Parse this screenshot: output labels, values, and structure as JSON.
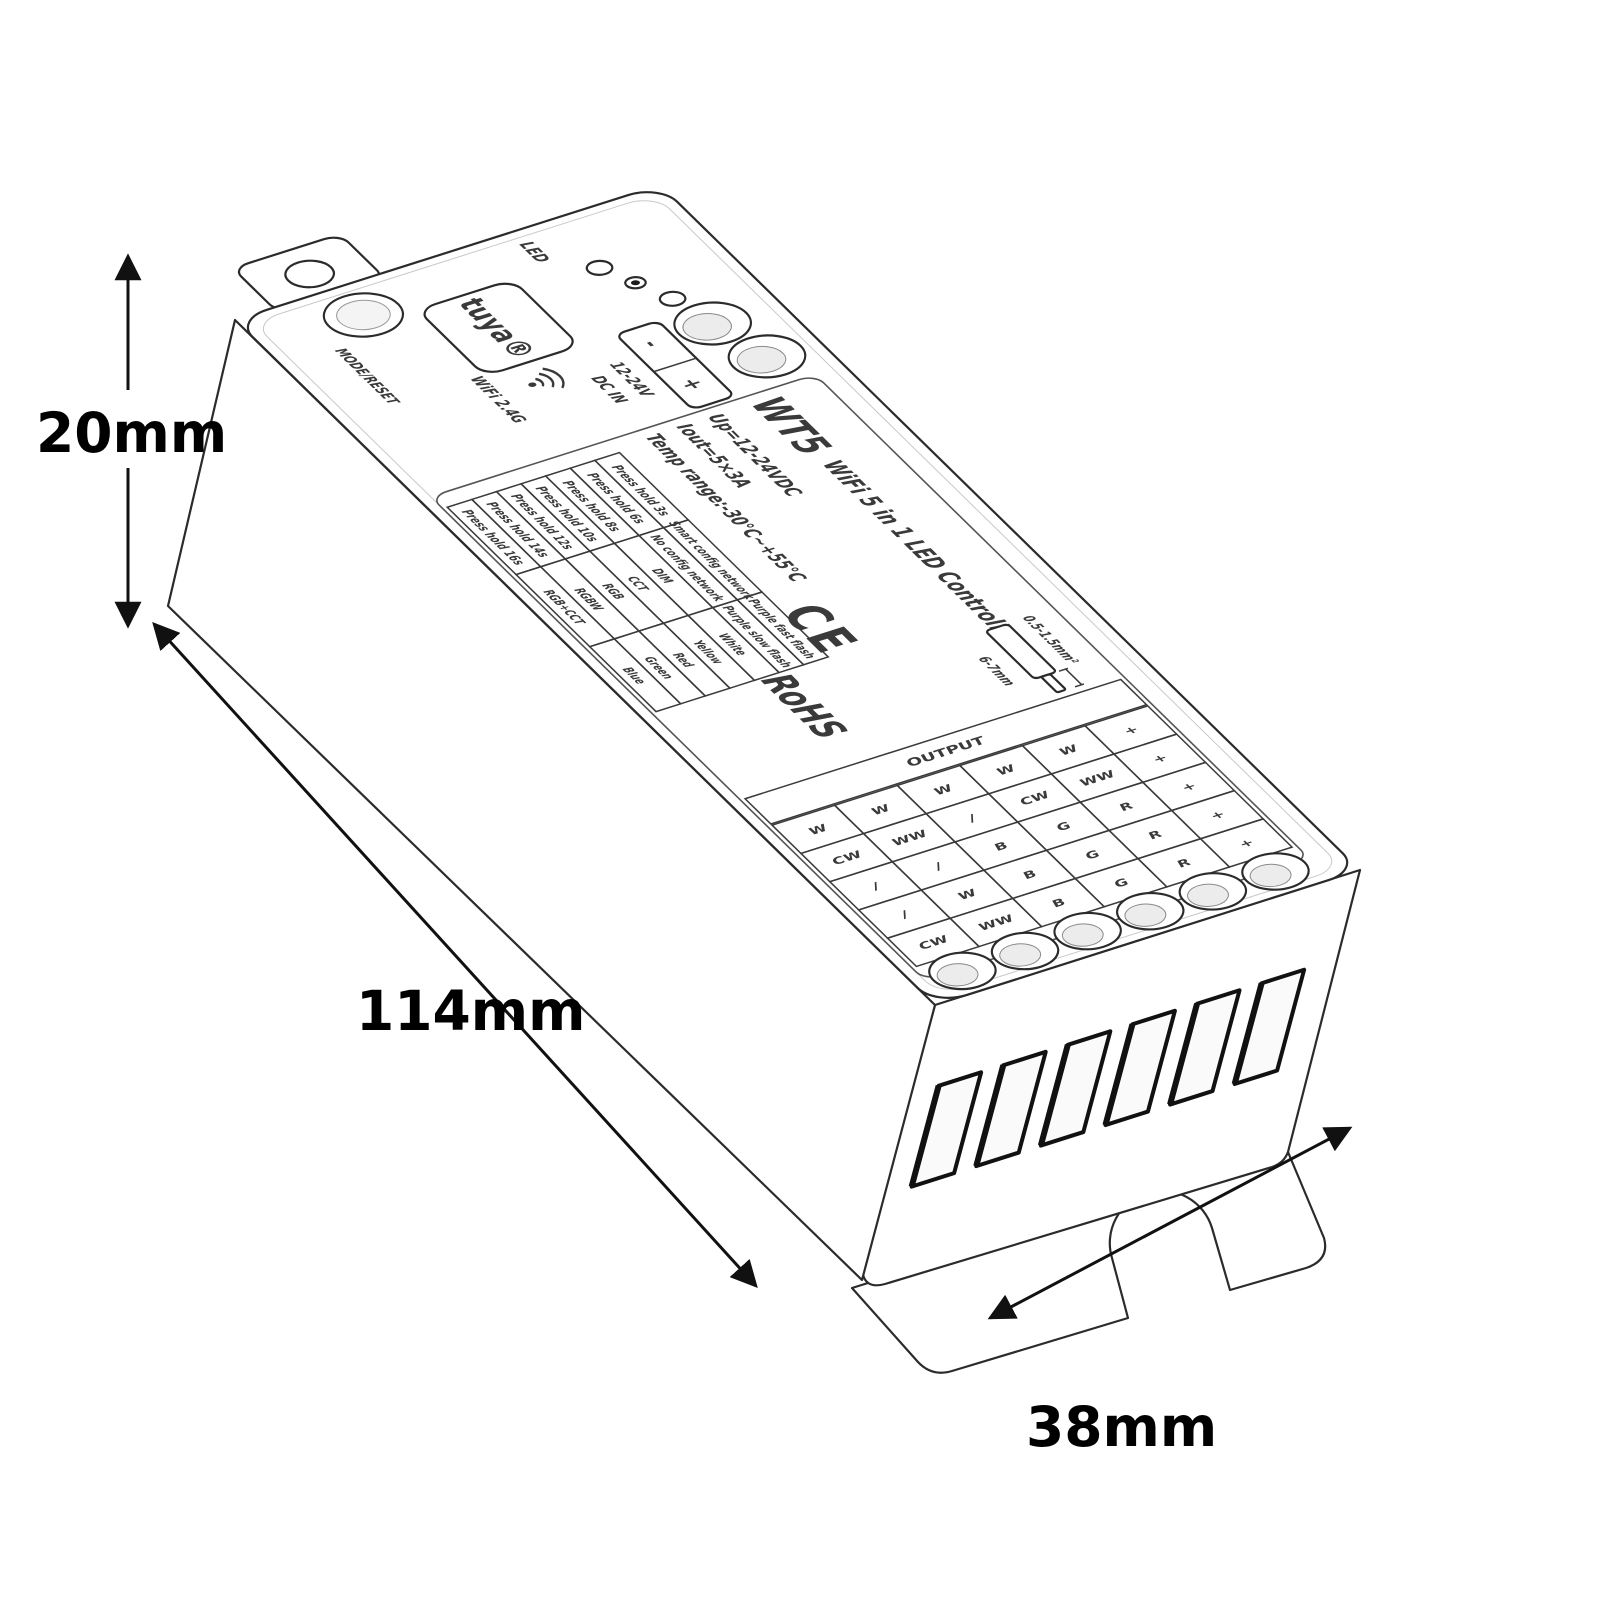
{
  "dimensions": {
    "height": "20mm",
    "length": "114mm",
    "width": "38mm"
  },
  "device": {
    "top": {
      "led_label": "LED",
      "button_label": "MODE/RESET",
      "brand": "tuya®",
      "wifi": "WiFi 2.4G",
      "power_in": {
        "neg": "-",
        "pos": "+",
        "line1": "12-24V",
        "line2": "DC IN"
      }
    },
    "label": {
      "model": "WT5",
      "title": "WiFi 5 in 1 LED Controller",
      "specs": [
        "Up=12-24VDC",
        "Iout=5×3A",
        "Temp range:-30℃~+55℃"
      ],
      "mode_table": {
        "rows": [
          {
            "press": "Press hold 3s",
            "mode": "Smart config network",
            "indicator": "Purple fast flash"
          },
          {
            "press": "Press hold 6s",
            "mode": "No config network",
            "indicator": "Purple slow flash"
          },
          {
            "press": "Press hold 8s",
            "mode": "DIM",
            "indicator": "White"
          },
          {
            "press": "Press hold 10s",
            "mode": "CCT",
            "indicator": "Yellow"
          },
          {
            "press": "Press hold 12s",
            "mode": "RGB",
            "indicator": "Red"
          },
          {
            "press": "Press hold 14s",
            "mode": "RGBW",
            "indicator": "Green"
          },
          {
            "press": "Press hold 16s",
            "mode": "RGB+CCT",
            "indicator": "Blue"
          }
        ]
      },
      "certifications": {
        "ce": "CE",
        "rohs": "RoHS"
      },
      "wire_note": {
        "gauge": "0.5-1.5mm²",
        "strip": "6-7mm"
      },
      "output_table": {
        "header": "OUTPUT",
        "columns": [
          [
            "+",
            "W",
            "W",
            "W",
            "W",
            "W"
          ],
          [
            "+",
            "WW",
            "CW",
            "/",
            "WW",
            "CW"
          ],
          [
            "+",
            "R",
            "G",
            "B",
            "/",
            "/"
          ],
          [
            "+",
            "R",
            "G",
            "B",
            "W",
            "/"
          ],
          [
            "+",
            "R",
            "G",
            "B",
            "WW",
            "CW"
          ]
        ]
      }
    }
  }
}
